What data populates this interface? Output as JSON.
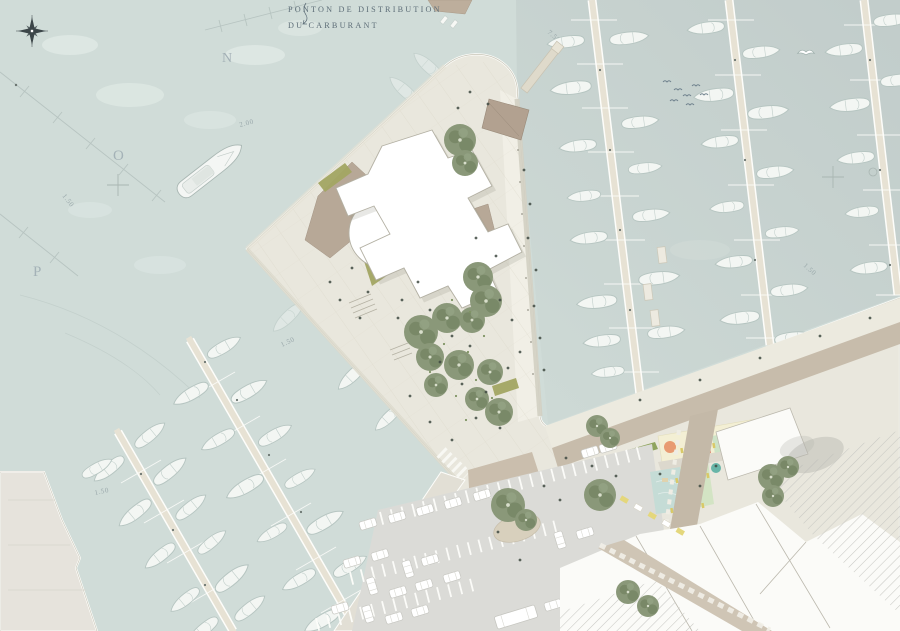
{
  "annotations": {
    "fuel_pontoon_label": {
      "line1": "PONTON DE DISTRIBUTION",
      "line2": "DU CARBURANT"
    },
    "berth_labels": [
      {
        "text": "N"
      },
      {
        "text": "O"
      },
      {
        "text": "P"
      }
    ],
    "depth_labels": [
      {
        "text": "2.00"
      },
      {
        "text": "1.50"
      },
      {
        "text": "7.50"
      },
      {
        "text": "1.50"
      },
      {
        "text": "1.50"
      },
      {
        "text": "1.50"
      }
    ]
  },
  "palette": {
    "water": "#d0dcd8",
    "water_deep": "#c3cecc",
    "land": "#e9e7dd",
    "plaza": "#ece9db",
    "promenade": "#f1efe6",
    "terrace": "#b7a897",
    "kiosk": "#b2a190",
    "road": "#c7bcab",
    "parking": "#dbdbd7",
    "building": "#ffffff",
    "tree": "#8a9879",
    "hedge": "#8fa45e",
    "planting": "#a2a562",
    "playground_yellow": "#f3efd4",
    "play_orange": "#e89b72",
    "play_salmon": "#e4836e",
    "play_teal": "#68b5a8",
    "court_green": "#cde3c6",
    "court_blue": "#c2dcd8",
    "pontoon": "#e7e2d4",
    "boat": "#f3f6f3",
    "label_text": "#5e6e78",
    "depth_text": "#9aa8ab",
    "hatch_line": "#c8c8c3"
  },
  "icons": {
    "compass_rose": "8-point-star",
    "seagull": "bird-glyph",
    "survey_cross": "plus-mark",
    "boat": "hull-outline",
    "tree": "canopy-circle",
    "car": "rounded-rect",
    "bus": "long-rounded-rect"
  }
}
